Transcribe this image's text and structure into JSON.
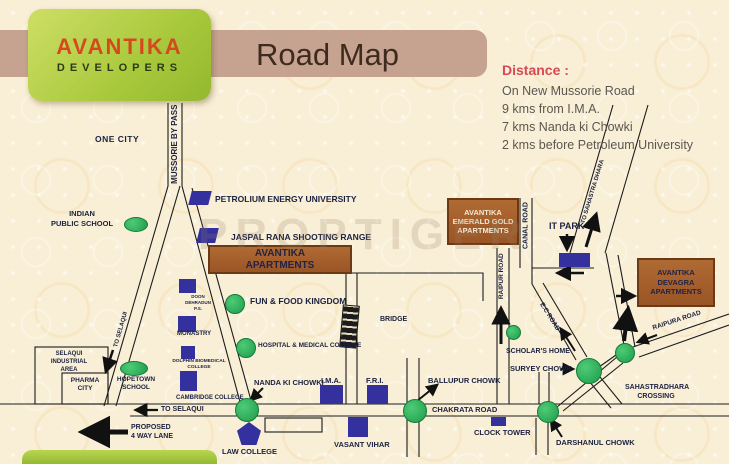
{
  "brand": {
    "name": "AVANTIKA",
    "tagline": "DEVELOPERS"
  },
  "header": {
    "title": "Road Map"
  },
  "distance": {
    "heading": "Distance :",
    "lines": [
      "On New Mussorie Road",
      "9 kms from I.M.A.",
      "7 kms Nanda ki Chowki",
      "2 kms before Petroleum University"
    ]
  },
  "watermark": "PROPTIGER",
  "colors": {
    "background": "#f9efd6",
    "header_band": "#c6a390",
    "logo_green": "#a9c93c",
    "brand_orange": "#d6491e",
    "title_brown": "#3f2b1e",
    "distance_red": "#d84856",
    "marker_green": "#1e9c4b",
    "building_blue": "#34319e",
    "project_brown": "#9a5526",
    "label_navy": "#1b2140"
  },
  "map": {
    "labels": {
      "one_city": "ONE CITY",
      "mussorie_bypass": "MUSSORIE BY PASS",
      "indian_public_school": "INDIAN\nPUBLIC SCHOOL",
      "petrolium_energy_university": "PETROLIUM ENERGY UNIVERSITY",
      "jaspal_rana": "JASPAL RANA SHOOTING RANGE",
      "avantika_apartments": "AVANTIKA\nAPARTMENTS",
      "fun_food": "FUN & FOOD KINGDOM",
      "bridge": "BRIDGE",
      "hospital": "HOSPITAL & MEDICAL COLLEGE",
      "doon_ps": "DOON\nDEHRADUN\nP.S.",
      "monastry": "MONASTRY",
      "dolphin": "DOLPHIN BIOMEDICAL\nCOLLEGE",
      "cambridge": "CAMBRIDGE COLLEGE",
      "selaqui_industrial": "SELAQUI\nINDUSTRIAL\nAREA",
      "pharma_city": "PHARMA\nCITY",
      "hopetown": "HOPETOWN\nSCHOOL",
      "to_selaqui_bypass": "TO SELAQUI",
      "to_selaqui_main": "TO SELAQUI",
      "proposed_lane": "PROPOSED\n4 WAY LANE",
      "law_college": "LAW COLLEGE",
      "nanda_ki_chowki": "NANDA KI CHOWKI",
      "ima": "I.M.A.",
      "fri": "F.R.I.",
      "vasant_vihar": "VASANT VIHAR",
      "ballupur_chowk": "BALLUPUR CHOWK",
      "chakrata_road": "CHAKRATA ROAD",
      "clock_tower": "CLOCK TOWER",
      "darshanul_chowk": "DARSHANUL CHOWK",
      "suryey_chowk": "SURYEY CHOWK",
      "scholars_home": "SCHOLAR'S HOME",
      "ec_road": "E.C ROAD",
      "sahastradhara_crossing": "SAHASTRADHARA\nCROSSING",
      "raipura_road": "RAIPURA ROAD",
      "raipur_road": "RAIPUR ROAD",
      "canal_road": "CANAL ROAD",
      "it_park": "IT PARK",
      "to_sahastradhara": "TO SAHASTRA DHARA",
      "avantika_emerald": "AVANTIKA\nEMERALD GOLD\nAPARTMENTS",
      "avantika_devagra": "AVANTIKA\nDEVAGRA\nAPARTMENTS"
    }
  }
}
